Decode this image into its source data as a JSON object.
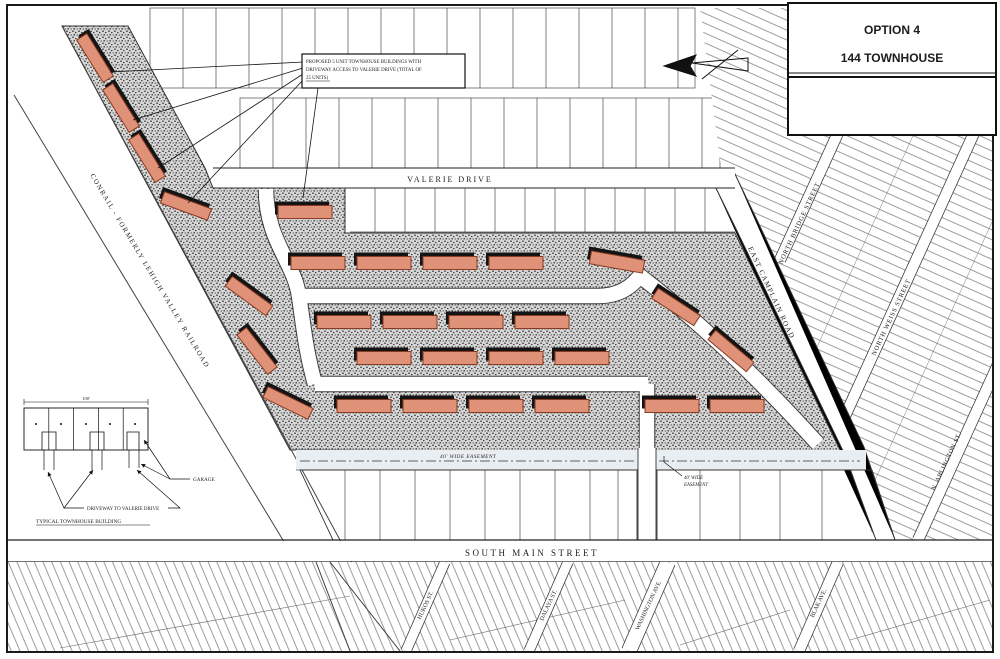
{
  "title_block": {
    "option": "OPTION 4",
    "name": "144 TOWNHOUSE"
  },
  "note_box": {
    "line1": "PROPOSED 5 UNIT TOWNHOUSE BUILDINGS WITH",
    "line2": "DRIVEWAY ACCESS TO VALERIE DRIVE (TOTAL OF",
    "line3": "25 UNITS)"
  },
  "railroad_label": "CONRAIL  -  FORMERLY LEHIGH VALLEY RAILROAD",
  "streets": {
    "valerie": "VALERIE DRIVE",
    "south_main": "SOUTH MAIN STREET",
    "camplain": "EAST CAMPLAIN ROAD",
    "north_bridge": "NORTH BRIDGE STREET",
    "north_weiss": "NORTH WEISS STREET",
    "arlington": "N. ARLINGTON ST.",
    "hukos": "HUKOS ST.",
    "dalaya": "DALAYA ST.",
    "washington": "WASHINGTON AVE.",
    "blak": "BLAK AVE."
  },
  "easement": {
    "center_label": "40' WIDE EASEMENT",
    "right_label_line1": "40' WIDE",
    "right_label_line2": "EASEMENT"
  },
  "detail_drawing": {
    "dimension_label": "100'",
    "garage_label": "GARAGE",
    "driveway_label": "DRIVEWAY TO VALERIE DRIVE",
    "caption": "TYPICAL TOWNHOUSE BUILDING"
  },
  "site": {
    "building_color": "#df9277",
    "building_edge": "#8a3a22",
    "shadow_color": "#141414",
    "buildings": [
      {
        "cx": 95,
        "cy": 58,
        "rot": 58,
        "w": 50,
        "h": 12
      },
      {
        "cx": 121,
        "cy": 108,
        "rot": 58,
        "w": 50,
        "h": 12
      },
      {
        "cx": 147,
        "cy": 158,
        "rot": 58,
        "w": 50,
        "h": 12
      },
      {
        "cx": 186,
        "cy": 206,
        "rot": 20,
        "w": 50,
        "h": 12
      },
      {
        "cx": 305,
        "cy": 212,
        "rot": 0,
        "w": 54,
        "h": 13
      },
      {
        "cx": 249,
        "cy": 296,
        "rot": 36,
        "w": 50,
        "h": 12
      },
      {
        "cx": 257,
        "cy": 351,
        "rot": 52,
        "w": 50,
        "h": 12
      },
      {
        "cx": 288,
        "cy": 403,
        "rot": 26,
        "w": 50,
        "h": 12
      },
      {
        "cx": 318,
        "cy": 263,
        "rot": 0,
        "w": 54,
        "h": 13
      },
      {
        "cx": 384,
        "cy": 263,
        "rot": 0,
        "w": 54,
        "h": 13
      },
      {
        "cx": 450,
        "cy": 263,
        "rot": 0,
        "w": 54,
        "h": 13
      },
      {
        "cx": 516,
        "cy": 263,
        "rot": 0,
        "w": 54,
        "h": 13
      },
      {
        "cx": 617,
        "cy": 262,
        "rot": 10,
        "w": 54,
        "h": 13
      },
      {
        "cx": 676,
        "cy": 307,
        "rot": 33,
        "w": 50,
        "h": 12
      },
      {
        "cx": 731,
        "cy": 351,
        "rot": 40,
        "w": 50,
        "h": 12
      },
      {
        "cx": 344,
        "cy": 322,
        "rot": 0,
        "w": 54,
        "h": 13
      },
      {
        "cx": 410,
        "cy": 322,
        "rot": 0,
        "w": 54,
        "h": 13
      },
      {
        "cx": 476,
        "cy": 322,
        "rot": 0,
        "w": 54,
        "h": 13
      },
      {
        "cx": 542,
        "cy": 322,
        "rot": 0,
        "w": 54,
        "h": 13
      },
      {
        "cx": 384,
        "cy": 358,
        "rot": 0,
        "w": 54,
        "h": 13
      },
      {
        "cx": 450,
        "cy": 358,
        "rot": 0,
        "w": 54,
        "h": 13
      },
      {
        "cx": 516,
        "cy": 358,
        "rot": 0,
        "w": 54,
        "h": 13
      },
      {
        "cx": 582,
        "cy": 358,
        "rot": 0,
        "w": 54,
        "h": 13
      },
      {
        "cx": 364,
        "cy": 406,
        "rot": 0,
        "w": 54,
        "h": 13
      },
      {
        "cx": 430,
        "cy": 406,
        "rot": 0,
        "w": 54,
        "h": 13
      },
      {
        "cx": 496,
        "cy": 406,
        "rot": 0,
        "w": 54,
        "h": 13
      },
      {
        "cx": 562,
        "cy": 406,
        "rot": 0,
        "w": 54,
        "h": 13
      },
      {
        "cx": 672,
        "cy": 406,
        "rot": 0,
        "w": 54,
        "h": 13
      },
      {
        "cx": 737,
        "cy": 406,
        "rot": 0,
        "w": 54,
        "h": 13
      }
    ]
  }
}
